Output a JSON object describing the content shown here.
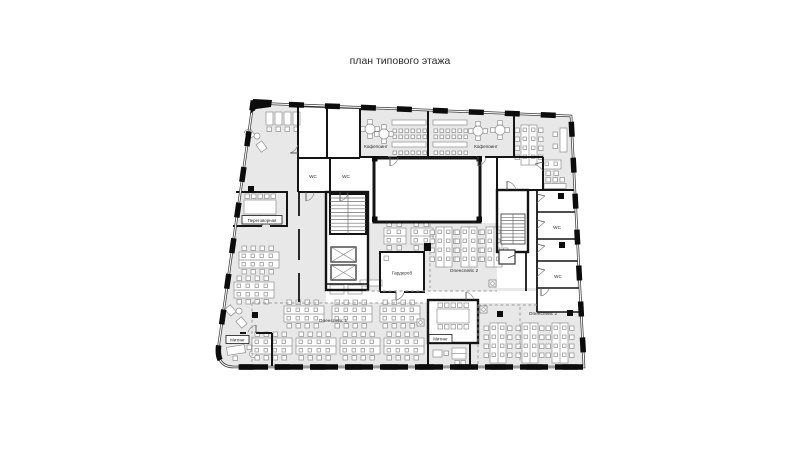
{
  "title": "план типового этажа",
  "colors": {
    "background": "#ffffff",
    "room_fill": "#e8e8e8",
    "wall": "#141414",
    "furniture_stroke": "#8f8f8f",
    "zone_dash": "#9a9a9a"
  },
  "rooms": {
    "coffee_point_1": {
      "label": "Кофепоинт"
    },
    "coffee_point_2": {
      "label": "Кофепоинт"
    },
    "wc_top_1": {
      "label": "WC"
    },
    "wc_top_2": {
      "label": "WC"
    },
    "wc_right_1": {
      "label": "WC"
    },
    "wc_right_2": {
      "label": "WC"
    },
    "negotiation_room": {
      "label": "Переговорная"
    },
    "wardrobe": {
      "label": "Гардероб"
    },
    "meeting_left": {
      "label": "Митинг"
    },
    "meeting_center": {
      "label": "Митинг"
    },
    "openspace_1": {
      "label": "Опенспейс 1"
    },
    "openspace_2_center": {
      "label": "Опенспейс 2"
    },
    "openspace_2_right": {
      "label": "Опенспейс 2"
    }
  }
}
